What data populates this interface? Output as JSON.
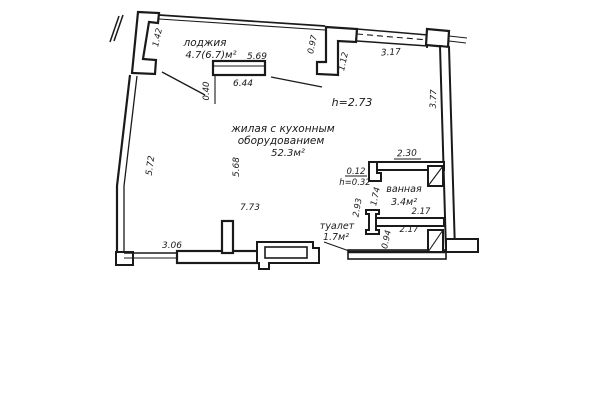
{
  "rooms": {
    "loggia": {
      "label": "лоджия",
      "area": "4.7(6.7)м²"
    },
    "living": {
      "label_line1": "жилая с кухонным",
      "label_line2": "оборудованием",
      "area": "52.3м²",
      "ceiling_height": "h=2.73"
    },
    "bathroom": {
      "label": "ванная",
      "area": "3.4м²"
    },
    "toilet": {
      "label": "туалет",
      "area": "1.7м²"
    }
  },
  "dimensions": {
    "loggia_window_width": "5.69",
    "loggia_inner_width": "6.44",
    "loggia_depth": "0.40",
    "loggia_side": "1.42",
    "top_jog_a": "0.97",
    "top_jog_b": "1.12",
    "top_right_span": "3.17",
    "right_wall": "3.77",
    "left_wall": "5.72",
    "living_depth": "5.68",
    "living_width": "7.73",
    "bottom_left": "3.06",
    "bath_top_width": "2.30",
    "bath_niche": "0.12",
    "bath_niche_height": "h=0.32",
    "bath_left_inner": "1.74",
    "bath_left_outer": "2.93",
    "bath_bottom_a": "2.17",
    "bath_bottom_b": "2.17",
    "toilet_side": "0.94"
  },
  "colors": {
    "ink": "#1a1a1a",
    "paper": "#ffffff"
  }
}
